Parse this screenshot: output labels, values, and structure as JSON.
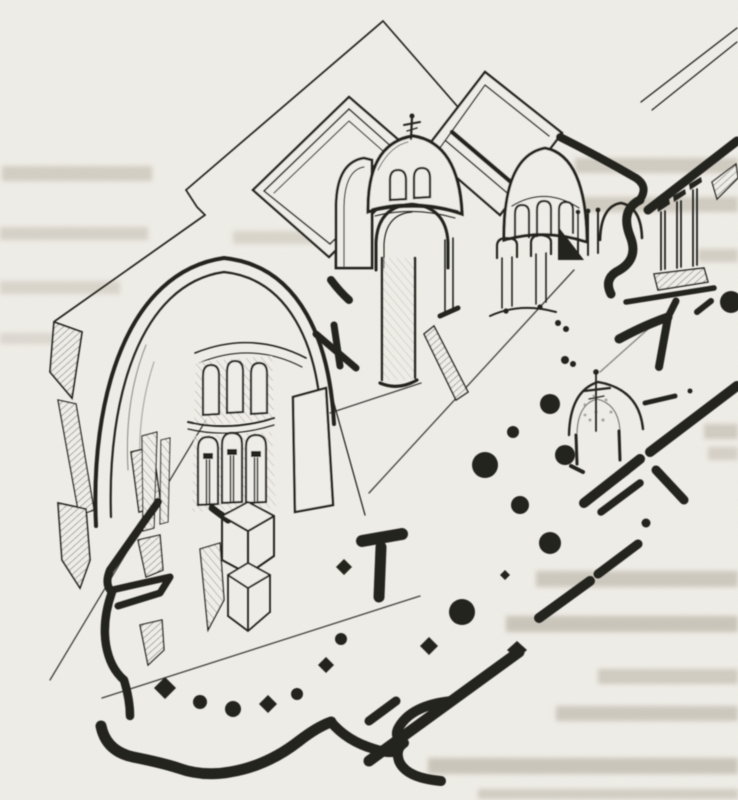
{
  "colors": {
    "paper": "#f1efe9",
    "ink": "#23211d",
    "ghost": "#a89f8f",
    "speckle": "#8a857c"
  },
  "figure": {
    "subject": "Scanned book illustration: axonometric cutaway drawing of a domed church combined with its floor plan",
    "kind": "scanned line drawing, black ink on yellowed paper",
    "parts": [
      "section-plane outline",
      "gabled roof volumes",
      "central dome with cross finial",
      "apse conch with arched windows",
      "colonnade in section",
      "cut-away main dome with two tiers of arched openings",
      "hatched wall cuts",
      "floor-plan walls drawn in solid black",
      "column dots of the plan",
      "small domed ciborium with cross",
      "scalloped rotunda wall"
    ]
  },
  "ghost_text": {
    "legible": false,
    "lines": 16,
    "appearance": "blurred mirrored print showing through the page"
  }
}
